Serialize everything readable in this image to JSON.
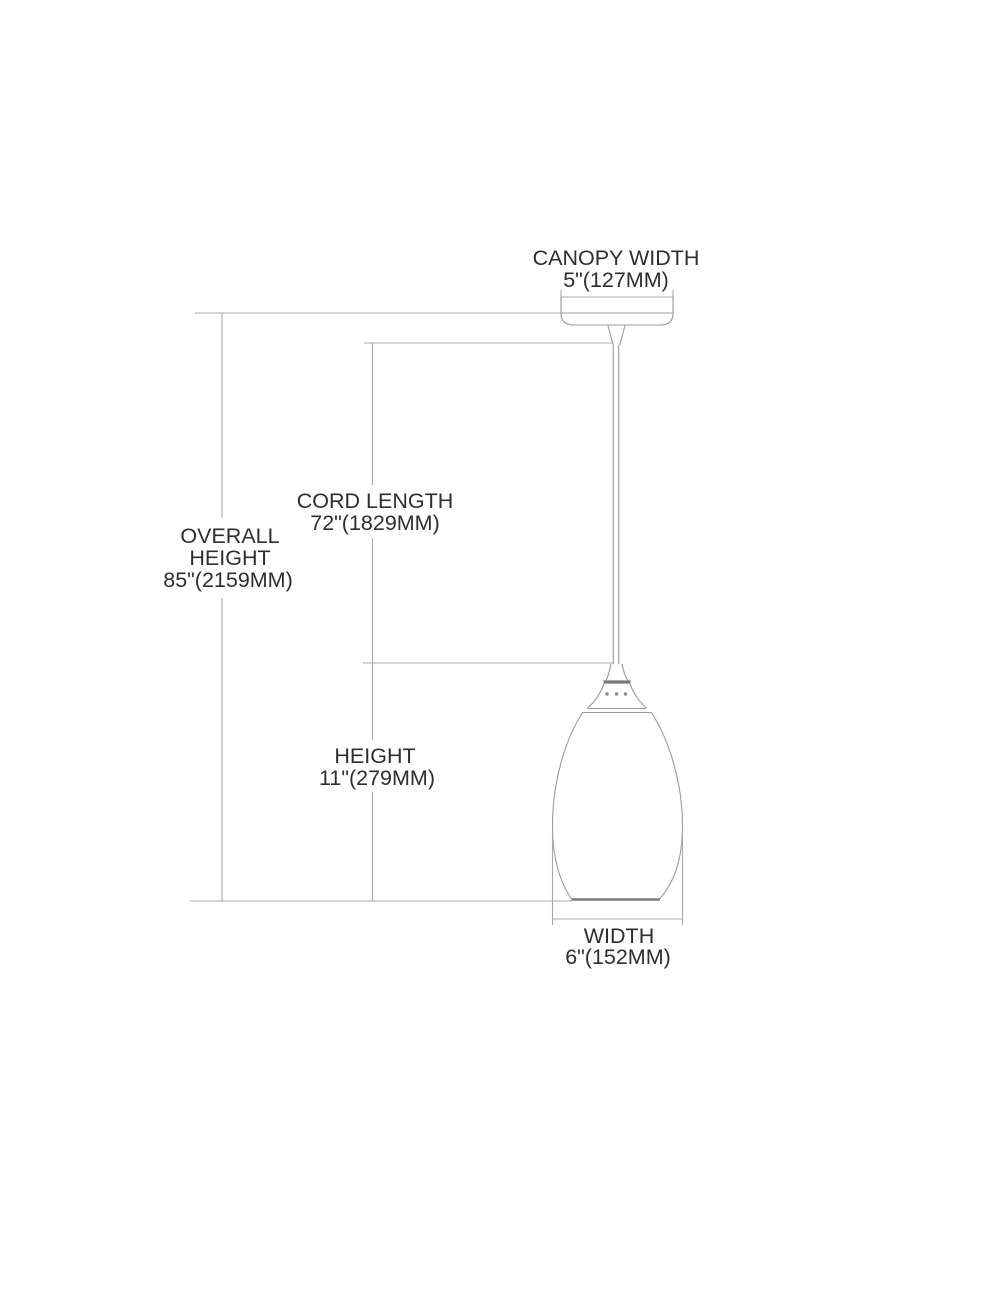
{
  "diagram_title": "Pendant light fixture dimension diagram",
  "labels": {
    "canopy_width": {
      "title": "CANOPY WIDTH",
      "value": "5\"(127MM)"
    },
    "overall_height": {
      "title_line1": "OVERALL",
      "title_line2": "HEIGHT",
      "value": "85\"(2159MM)"
    },
    "cord_length": {
      "title": "CORD LENGTH",
      "value": "72\"(1829MM)"
    },
    "height": {
      "title": "HEIGHT",
      "value": "11\"(279MM)"
    },
    "width": {
      "title": "WIDTH",
      "value": "6\"(152MM)"
    }
  },
  "colors": {
    "background": "#ffffff",
    "dimension_line": "#a9a9a9",
    "fixture_outline": "#9b9b9b",
    "accent_dark": "#7a7a7a",
    "label_text": "#2e2e2e"
  }
}
